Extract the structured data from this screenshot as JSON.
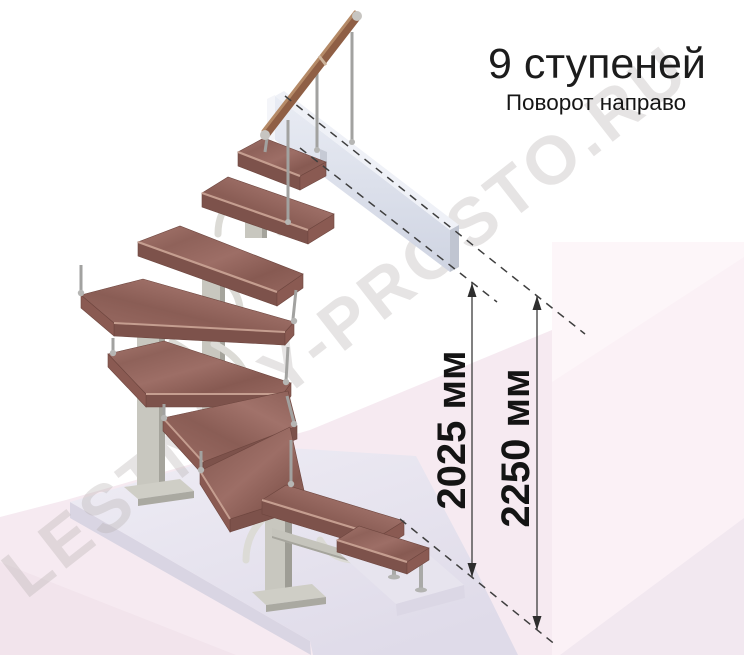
{
  "header": {
    "title": "9 ступеней",
    "subtitle": "Поворот направо"
  },
  "dimensions": [
    {
      "label": "2025 мм",
      "meaning": "height to top step"
    },
    {
      "label": "2250 мм",
      "meaning": "floor-to-floor height"
    }
  ],
  "watermark": {
    "text": "LESTNICY-PROSTO.RU"
  },
  "diagram": {
    "type": "3d-render-staircase",
    "steps_count": "9",
    "turn": "направо",
    "colors": {
      "wood": "#96675f",
      "wood_front": "#7d524b",
      "handrail": "#8f5f45",
      "metal_post": "#c8c7bf",
      "chrome": "#a2a2a0",
      "floor_pink": "#f6eaf1",
      "panel_pink": "#fbf1f6",
      "platform": "#e9e6f1",
      "upper_slab": "#dfe4ee",
      "annotation": "#2e2e2e",
      "text": "#1c1c1c"
    }
  }
}
